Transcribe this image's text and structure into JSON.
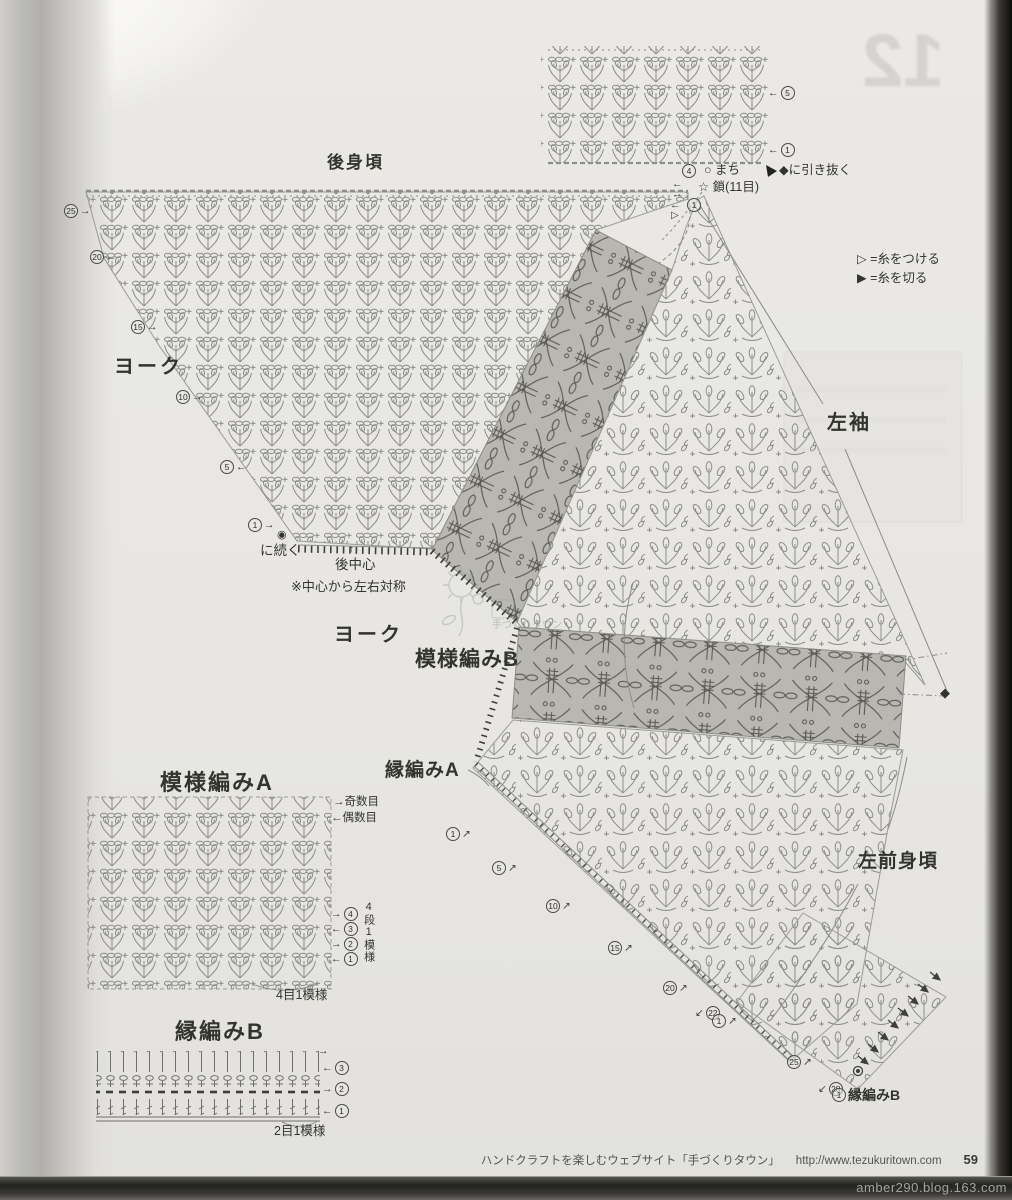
{
  "titles": {
    "back_body": "後身頃",
    "yoke_upper": "ヨーク",
    "yoke_lower": "ヨーク",
    "left_sleeve": "左袖",
    "pattern_b": "模様編みB",
    "edge_a": "縁編みA",
    "pattern_a": "模様編みA",
    "edge_b": "縁編みB",
    "left_front": "左前身頃",
    "edge_b_row1_label": "縁編みB"
  },
  "annotations": {
    "machi": "○ まち",
    "chain11": "☆ 鎖(11目)",
    "slip_to_diamond": "◆に引き抜く",
    "continue_sym": "◉",
    "continue_to": "に続く",
    "back_center": "後中心",
    "up_arrow": "↑",
    "symmetry_note": "※中心から左右対称",
    "odd_rows": "→奇数目",
    "even_rows": "←偶数目",
    "repeat_4rows": "4段1模様",
    "repeat_4sts": "4目1模様",
    "repeat_2sts": "2目1模様",
    "diamond": "◆",
    "attach_marker": "▷"
  },
  "legend": {
    "attach": "▷ =糸をつける",
    "cut": "▶ =糸を切る"
  },
  "markers": {
    "left": [
      {
        "num": "25",
        "arrow": "→"
      },
      {
        "num": "20",
        "arrow": "←"
      },
      {
        "num": "15",
        "arrow": "→"
      },
      {
        "num": "10",
        "arrow": "→"
      },
      {
        "num": "5",
        "arrow": "←"
      },
      {
        "num": "1",
        "arrow": "→"
      }
    ],
    "top_chart": [
      {
        "arrow": "←",
        "num": "5"
      },
      {
        "arrow": "←",
        "num": "1"
      }
    ],
    "underarm": {
      "num4": "4",
      "num1": "1",
      "a1": "←",
      "a2": "→",
      "a3": "←"
    },
    "front_edge": [
      {
        "num": "1",
        "arrow": "↗"
      },
      {
        "num": "5",
        "arrow": "↗"
      },
      {
        "num": "10",
        "arrow": "↗"
      },
      {
        "num": "15",
        "arrow": "↗"
      },
      {
        "num": "20",
        "arrow": "↗"
      },
      {
        "num": "22",
        "arrow": "↙"
      },
      {
        "num": "1",
        "arrow": "↗"
      },
      {
        "num": "25",
        "arrow": "↗"
      },
      {
        "num": "28",
        "arrow": "↙"
      }
    ],
    "edge_b_row1_num": "1",
    "pattern_a": [
      {
        "arrow": "→",
        "num": "4"
      },
      {
        "arrow": "←",
        "num": "3"
      },
      {
        "arrow": "→",
        "num": "2"
      },
      {
        "arrow": "←",
        "num": "1"
      }
    ],
    "edge_b": [
      {
        "arrow": "→"
      },
      {
        "arrow": "←",
        "num": "3"
      },
      {
        "arrow": "→",
        "num": "2"
      },
      {
        "arrow": "←",
        "num": "1"
      }
    ]
  },
  "footer": {
    "site": "ハンドクラフトを楽しむウェブサイト「手づくりタウン」",
    "url": "http://www.tezukuritown.com",
    "page_number": "59"
  },
  "watermarks": {
    "blog": "amber290.blog.163.com",
    "logo_text": "手づくりタウン",
    "bleed_number": "12"
  },
  "colors": {
    "paper": "#e9e8e4",
    "stitch_ink": "#8a8a86",
    "label_ink": "#34342f",
    "band_bg": "#b9b7b2",
    "band_ink": "#59594f"
  }
}
